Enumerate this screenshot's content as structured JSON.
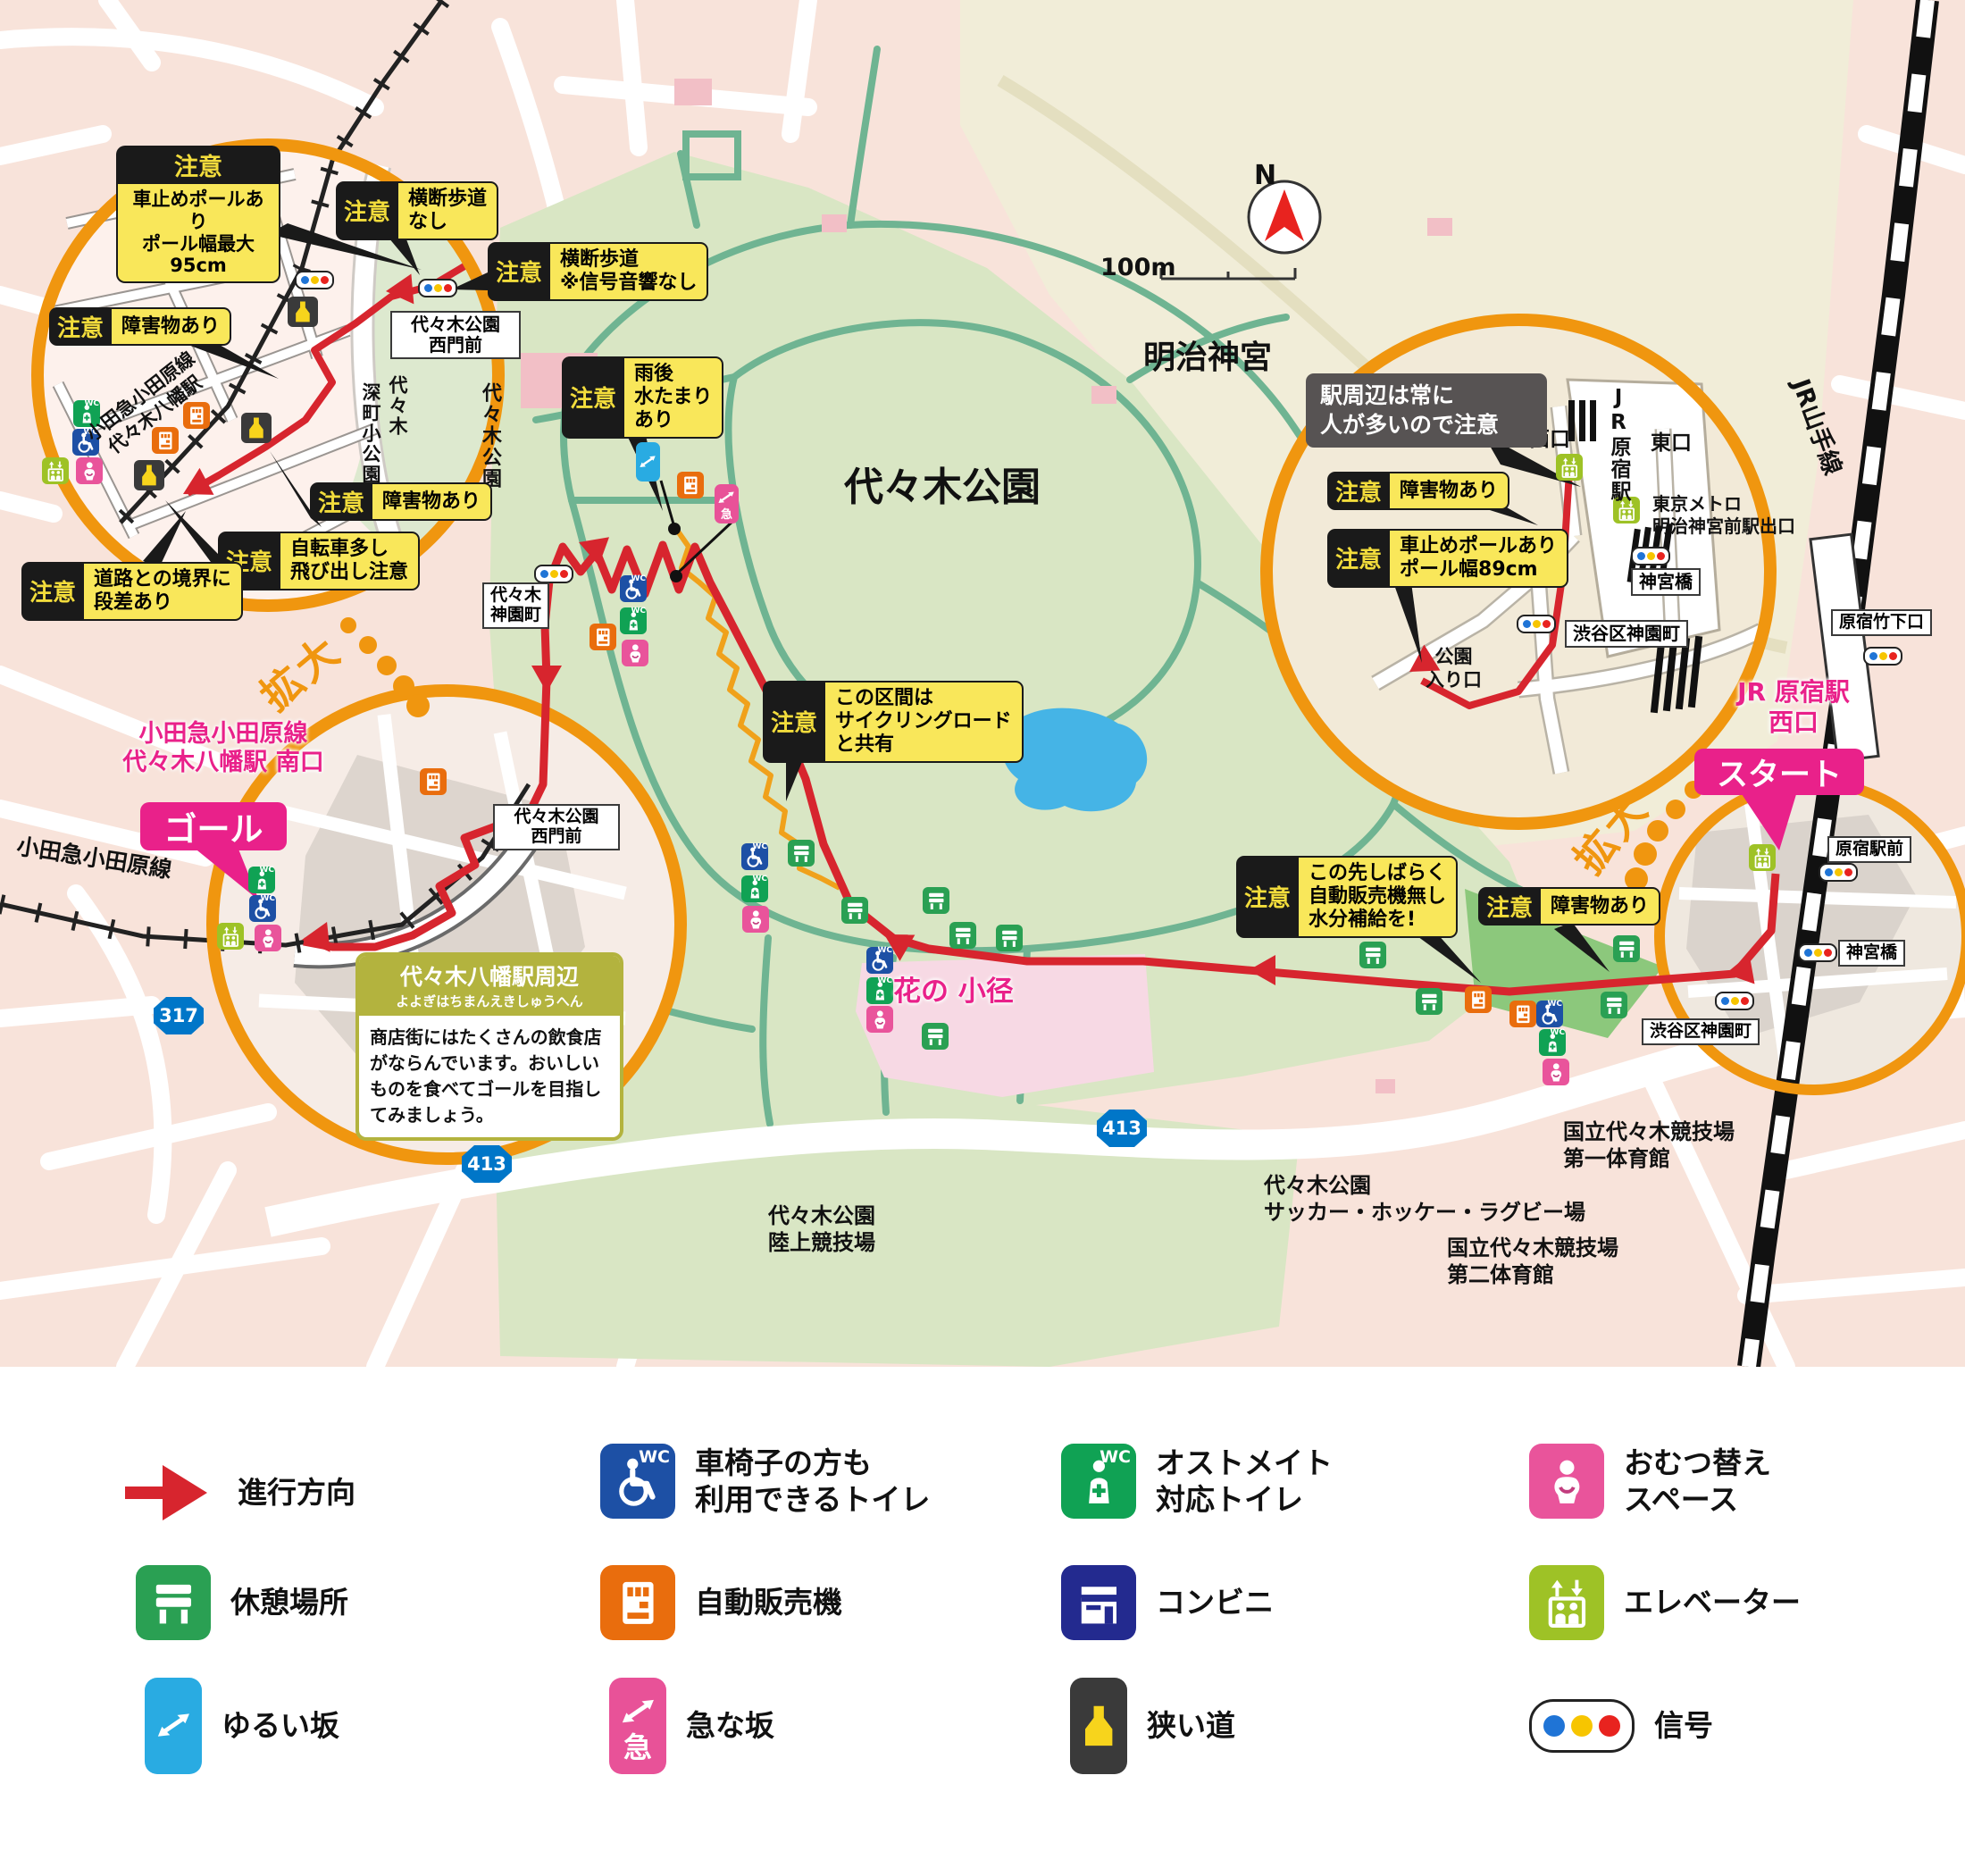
{
  "colors": {
    "accent_pink": "#e9218a",
    "circle_orange": "#f0960f",
    "route_red": "#d7252e",
    "caution_yellow": "#f9e75a",
    "park_green": "#d9e6c4",
    "path_teal": "#6fb492"
  },
  "icon_text": {
    "wc": "WC",
    "steep": "急",
    "north": "N"
  },
  "scale": {
    "label": "100m"
  },
  "zoom": {
    "label": "拡大"
  },
  "route_shields": {
    "r317": "317",
    "r413": "413"
  },
  "region": {
    "meiji": "明治神宮",
    "park": "代々木公園",
    "yamanote": "JR山手線",
    "odakyu": "小田急小田原線",
    "flower": "花の 小径",
    "athletics": "代々木公園\n陸上競技場",
    "soccer": "代々木公園\nサッカー・ホッケー・ラグビー場",
    "gym1": "国立代々木競技場\n第一体育館",
    "gym2": "国立代々木競技場\n第二体育館"
  },
  "start": {
    "box": "スタート",
    "station": "JR 原宿駅\n西口"
  },
  "goal": {
    "box": "ゴール",
    "station": "小田急小田原線\n代々木八幡駅 南口"
  },
  "left_circle": {
    "note_pole": {
      "badge": "注意",
      "text": "車止めポールあり\nポール幅最大95cm"
    },
    "note_no_crossing": {
      "badge": "注意",
      "text": "横断歩道\nなし"
    },
    "note_no_sound": {
      "badge": "注意",
      "text": "横断歩道\n※信号音響なし"
    },
    "note_obstacle1": {
      "badge": "注意",
      "text": "障害物あり"
    },
    "note_obstacle2": {
      "badge": "注意",
      "text": "障害物あり"
    },
    "note_bicycle": {
      "badge": "注意",
      "text": "自転車多し\n飛び出し注意"
    },
    "note_step": {
      "badge": "注意",
      "text": "道路との境界に\n段差あり"
    },
    "rail": "小田急小田原線\n代々木八幡駅",
    "park_v1": "代々木",
    "park_v2": "深町小公園",
    "park_side": "代々木公園",
    "gate": "代々木公園\n西門前"
  },
  "right_circle": {
    "crowd": "駅周辺は常に\n人が多いので注意",
    "note_obstacle": {
      "badge": "注意",
      "text": "障害物あり"
    },
    "note_pole": {
      "badge": "注意",
      "text": "車止めポールあり\nポール幅89cm"
    },
    "west": "西口",
    "east": "東口",
    "station": "JR原宿駅",
    "metro": "東京メトロ\n明治神宮前駅出口",
    "bridge": "神宮橋",
    "town": "渋谷区神園町",
    "entrance": "公園\n入り口"
  },
  "notes": {
    "puddle": {
      "badge": "注意",
      "text": "雨後\n水たまり\nあり"
    },
    "cycling": {
      "badge": "注意",
      "text": "この区間は\nサイクリングロード\nと共有"
    },
    "no_vending": {
      "badge": "注意",
      "text": "この先しばらく\n自動販売機無し\n水分補給を!"
    },
    "obstacle": {
      "badge": "注意",
      "text": "障害物あり"
    }
  },
  "places": {
    "gate_main": "代々木公園\n西門前",
    "kamizono": "代々木\n神園町",
    "ekimae": "原宿駅前",
    "bridge": "神宮橋",
    "shibuya": "渋谷区神園町",
    "takeshita": "原宿竹下口"
  },
  "goal_info": {
    "title": "代々木八幡駅周辺",
    "kana": "よよぎはちまんえきしゅうへん",
    "body": "商店街にはたくさんの飲食店がならんでいます。おいしいものを食べてゴールを目指してみましょう。"
  },
  "legend": {
    "items": [
      {
        "icon": "direction-arrow",
        "label": "進行方向"
      },
      {
        "icon": "wheelchair-toilet",
        "label": "車椅子の方も\n利用できるトイレ"
      },
      {
        "icon": "ostomate-toilet",
        "label": "オストメイト\n対応トイレ"
      },
      {
        "icon": "diaper-space",
        "label": "おむつ替え\nスペース"
      },
      {
        "icon": "rest-area",
        "label": "休憩場所"
      },
      {
        "icon": "vending-machine",
        "label": "自動販売機"
      },
      {
        "icon": "convenience-store",
        "label": "コンビニ"
      },
      {
        "icon": "elevator",
        "label": "エレベーター"
      },
      {
        "icon": "gentle-slope",
        "label": "ゆるい坂"
      },
      {
        "icon": "steep-slope",
        "label": "急な坂"
      },
      {
        "icon": "narrow-road",
        "label": "狭い道"
      },
      {
        "icon": "traffic-signal",
        "label": "信号"
      }
    ]
  }
}
